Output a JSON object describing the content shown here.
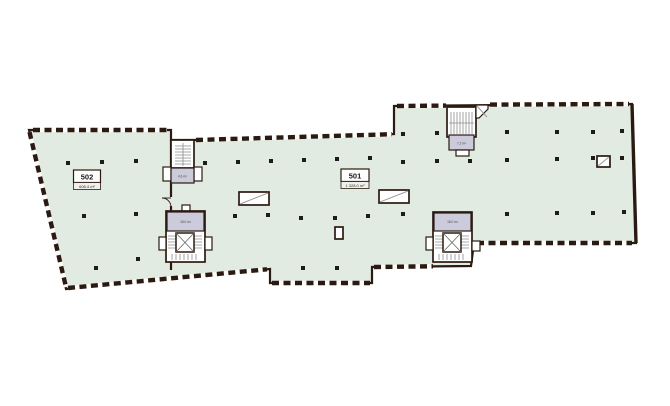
{
  "canvas": {
    "background": "#ffffff"
  },
  "plan": {
    "colors": {
      "floor": "#e2ebe1",
      "core": "#cbcbdc",
      "wall": "#2a1a12",
      "stair": "#8d8d8d",
      "column": "#1c1c1c"
    },
    "units": [
      {
        "id": "502",
        "area": "608.4 m²"
      },
      {
        "id": "501",
        "area": "1 328.0 m²"
      }
    ],
    "cores": {
      "west_stair": "4.6 m²",
      "west_elevator": "18.0 m²",
      "north_stair": "7.2 m²",
      "east_elevator": "18.0 m²"
    }
  }
}
